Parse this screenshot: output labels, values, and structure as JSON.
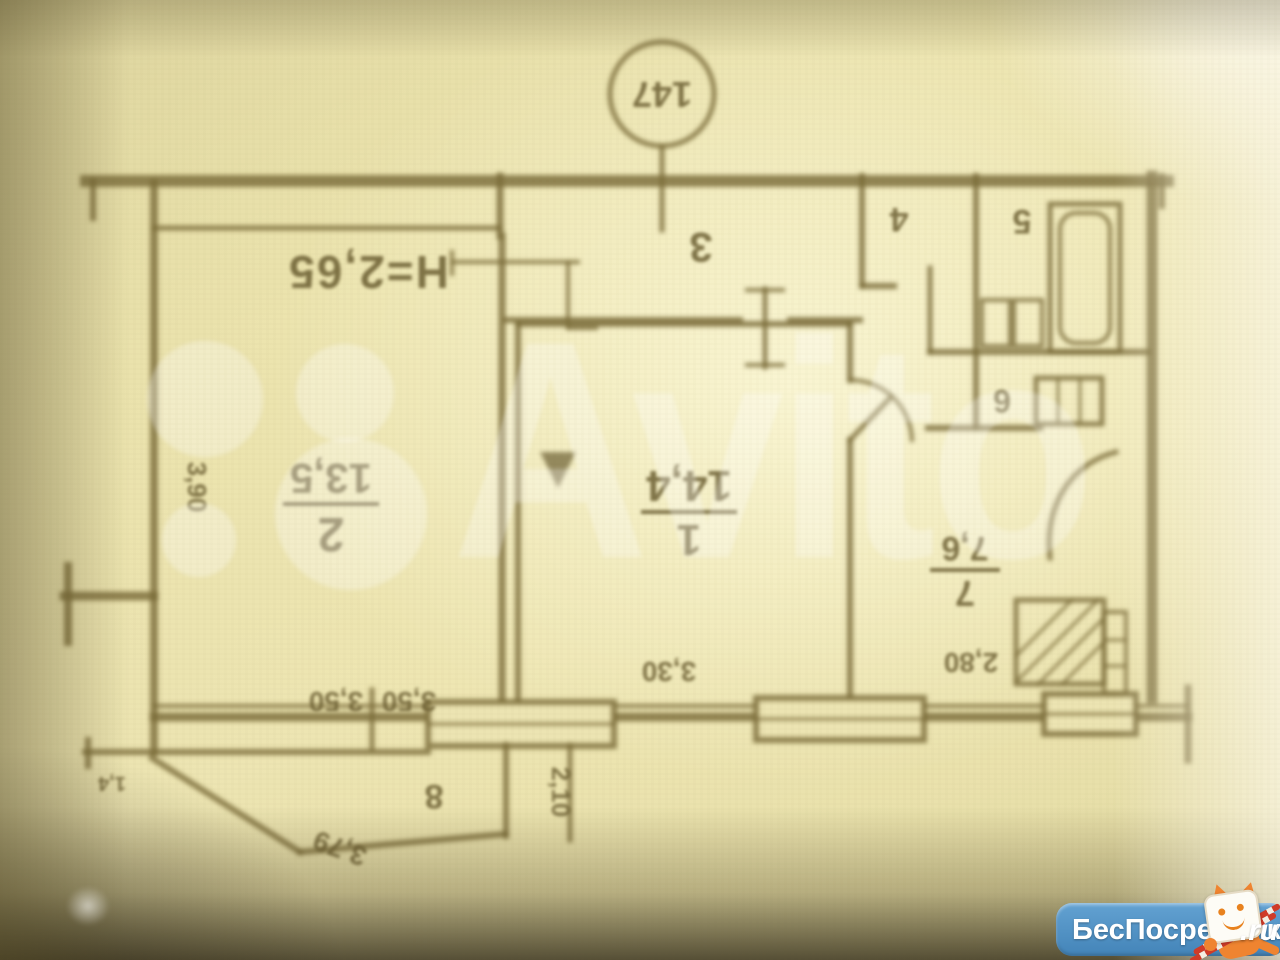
{
  "floorplan": {
    "apartment_number": "147",
    "ceiling_height_label": "H=2,65",
    "rooms": {
      "room1": {
        "number": "1",
        "area": "14,4"
      },
      "room2": {
        "number": "2",
        "area": "13,5"
      },
      "room3": {
        "number": "3"
      },
      "room4": {
        "number": "4"
      },
      "room5": {
        "number": "5"
      },
      "room6": {
        "number": "6"
      },
      "room7": {
        "number": "7",
        "area": "7,6"
      },
      "room8": {
        "number": "8"
      }
    },
    "dimensions": {
      "dim_350_left": "3,50",
      "dim_350_right": "3,50",
      "dim_330": "3,30",
      "dim_280": "2,80",
      "dim_210": "2,10",
      "dim_390": "3,90",
      "dim_379": "3,79",
      "dim_14": "1,4"
    }
  },
  "watermarks": {
    "avito": {
      "wordmark": "Avito"
    },
    "besposrednika": {
      "name": "БесПосредника",
      "tld": ".ru"
    }
  },
  "colors": {
    "paper": "#e8e0aa",
    "ink": "#6b5e32",
    "avito_white": "rgba(255,255,255,0.30)",
    "badge_blue": "#4d8fc4",
    "cat_orange": "#ef8430"
  }
}
